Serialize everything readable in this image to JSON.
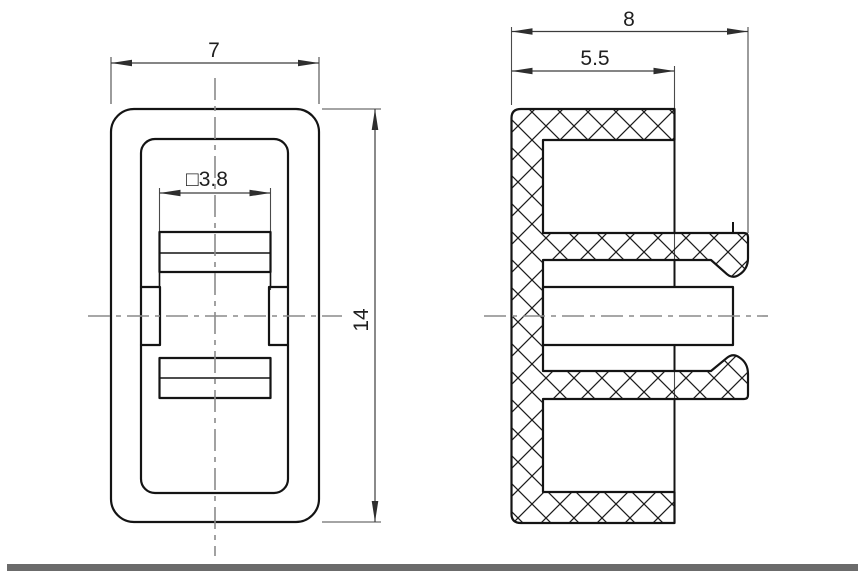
{
  "drawing": {
    "kind": "engineering-drawing",
    "views": {
      "front": {
        "name": "front-view",
        "dimensions": {
          "width": {
            "label": "7",
            "orientation": "horizontal"
          },
          "height": {
            "label": "14",
            "orientation": "vertical"
          },
          "hole": {
            "label": "□3.8",
            "orientation": "horizontal"
          }
        }
      },
      "section": {
        "name": "side-section-view",
        "hatch": "crosshatch",
        "dimensions": {
          "overall_depth": {
            "label": "8",
            "orientation": "horizontal"
          },
          "flange_depth": {
            "label": "5.5",
            "orientation": "horizontal"
          }
        }
      }
    },
    "colors": {
      "background": "#ffffff",
      "outline": "#141414",
      "hatch_line": "#1c1c1c",
      "dimension_line": "#3c3c3c",
      "centerline": "#8a8a8a",
      "bottom_border_bar": "#6b6b6b"
    }
  }
}
